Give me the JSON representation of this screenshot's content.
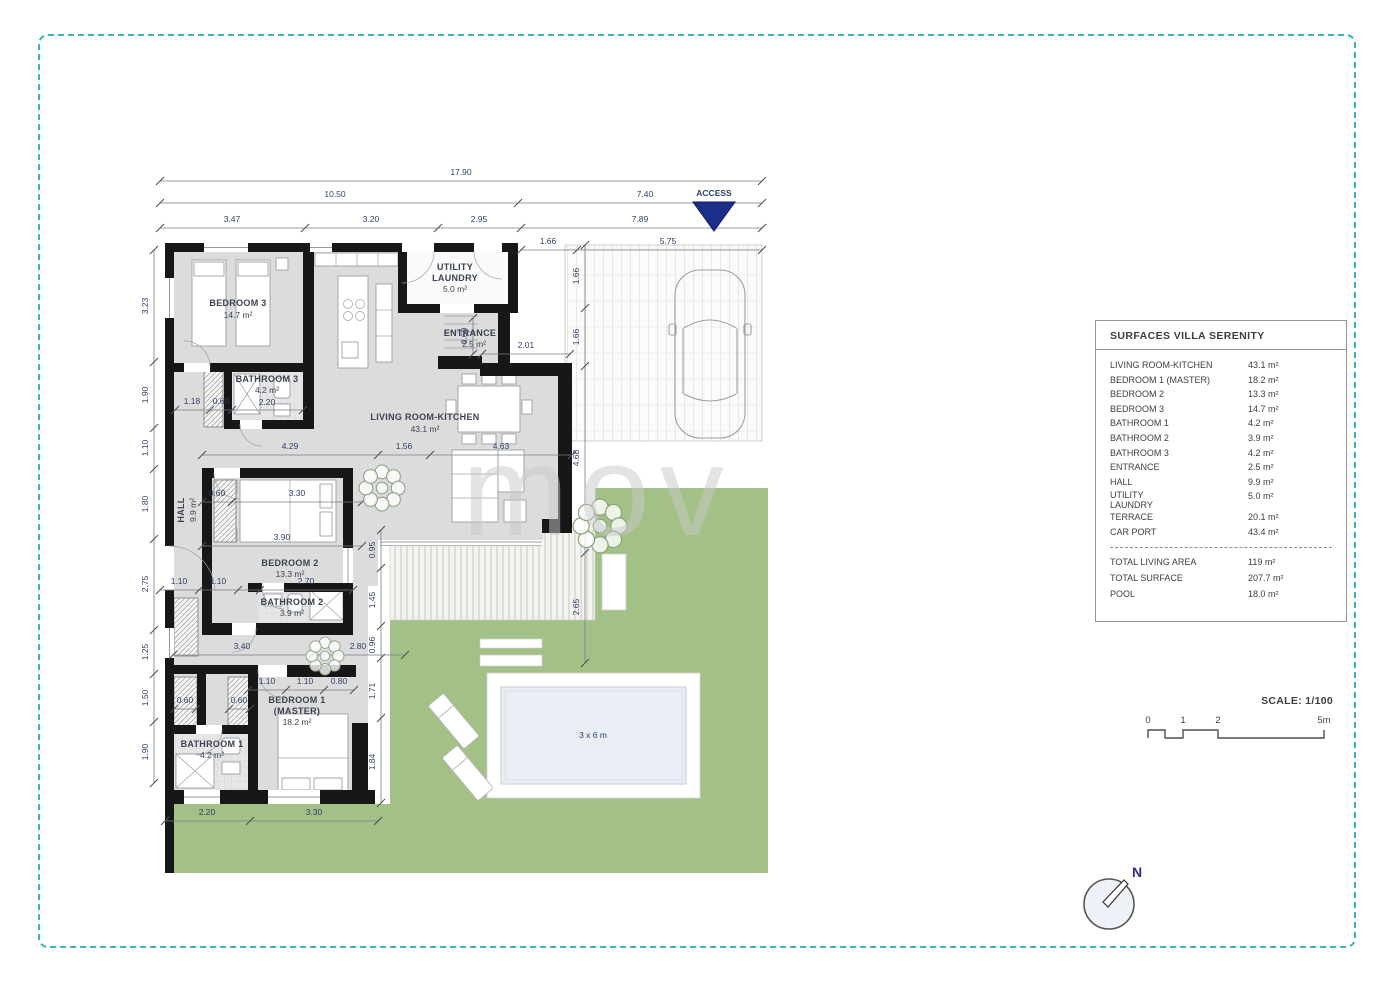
{
  "page": {
    "border_color": "#3ab4bf",
    "background": "#ffffff"
  },
  "watermark": {
    "text": "mov"
  },
  "plan": {
    "access_label": "ACCESS",
    "access_color": "#1c2e8a",
    "rooms": {
      "bedroom3": {
        "label": "BEDROOM 3",
        "area": "14.7 m²"
      },
      "bathroom3": {
        "label": "BATHROOM 3",
        "area": "4.2 m²"
      },
      "utility": {
        "line1": "UTILITY",
        "line2": "LAUNDRY",
        "area": "5.0 m²"
      },
      "entrance": {
        "label": "ENTRANCE",
        "area": "2.5 m²"
      },
      "living": {
        "label": "LIVING ROOM-KITCHEN",
        "area": "43.1 m²"
      },
      "hall": {
        "label": "HALL",
        "area": "9.9 m²"
      },
      "bedroom2": {
        "label": "BEDROOM 2",
        "area": "13.3 m²"
      },
      "bathroom2": {
        "label": "BATHROOM 2",
        "area": "3.9 m²"
      },
      "bedroom1": {
        "line1": "BEDROOM 1",
        "line2": "(MASTER)",
        "area": "18.2 m²"
      },
      "bathroom1": {
        "label": "BATHROOM 1",
        "area": "4.2 m²"
      }
    },
    "pool_label": "3 x 6 m",
    "dims": {
      "total_width": "17.90",
      "left_width": "10.50",
      "right_width": "7.40",
      "top_row": [
        "3.47",
        "3.20",
        "2.95",
        "7.89"
      ],
      "carport_row": [
        "1.66",
        "5.75"
      ],
      "left_col": [
        "3.23",
        "1.90",
        "1.10",
        "1.80",
        "2.75",
        "1.25",
        "1.50",
        "1.90"
      ],
      "mid_row": [
        "4.29",
        "1.56",
        "4.63"
      ],
      "carport_col": [
        "1.66",
        "1.66",
        "4.68",
        "2.65"
      ],
      "terrace_col": [
        "0.95",
        "1.45",
        "0.96",
        "1.71",
        "1.84"
      ],
      "bath3_row": [
        "1.18",
        "0.60",
        "2.20"
      ],
      "entrance_w": "2.01",
      "entrance_d": "0.60",
      "bedroom2_row": [
        "0.60",
        "3.30"
      ],
      "bedroom2_w": "3.90",
      "bath2_row": [
        "1.10",
        "1.10",
        "2.70"
      ],
      "corridor_row": [
        "3.40",
        "2.80"
      ],
      "bedroom1_row": [
        "1.10",
        "1.10",
        "0.80"
      ],
      "closet_dims": [
        "0.60",
        "0.60"
      ],
      "bottom_row": [
        "2.20",
        "3.30"
      ]
    }
  },
  "legend": {
    "title": "SURFACES VILLA SERENITY",
    "rows": [
      {
        "label": "LIVING ROOM-KITCHEN",
        "value": "43.1 m²"
      },
      {
        "label": "BEDROOM 1 (MASTER)",
        "value": "18.2 m²"
      },
      {
        "label": "BEDROOM 2",
        "value": "13.3 m²"
      },
      {
        "label": "BEDROOM 3",
        "value": "14.7 m²"
      },
      {
        "label": "BATHROOM 1",
        "value": "4.2 m²"
      },
      {
        "label": "BATHROOM 2",
        "value": "3.9 m²"
      },
      {
        "label": "BATHROOM 3",
        "value": "4.2 m²"
      },
      {
        "label": "ENTRANCE",
        "value": "2.5 m²"
      },
      {
        "label": "HALL",
        "value": "9.9 m²"
      },
      {
        "label_line1": "UTILITY",
        "label_line2": "LAUNDRY",
        "value": "5.0 m²"
      },
      {
        "label": "TERRACE",
        "value": "20.1 m²"
      },
      {
        "label": "CAR PORT",
        "value": "43.4 m²"
      }
    ],
    "totals": [
      {
        "label": "TOTAL LIVING AREA",
        "value": "119 m²"
      },
      {
        "label": "TOTAL SURFACE",
        "value": "207.7 m²"
      },
      {
        "label": "POOL",
        "value": "18.0 m²"
      }
    ]
  },
  "scale": {
    "title": "SCALE: 1/100",
    "ticks": [
      "0",
      "1",
      "2",
      "5m"
    ]
  },
  "compass": {
    "label": "N"
  }
}
